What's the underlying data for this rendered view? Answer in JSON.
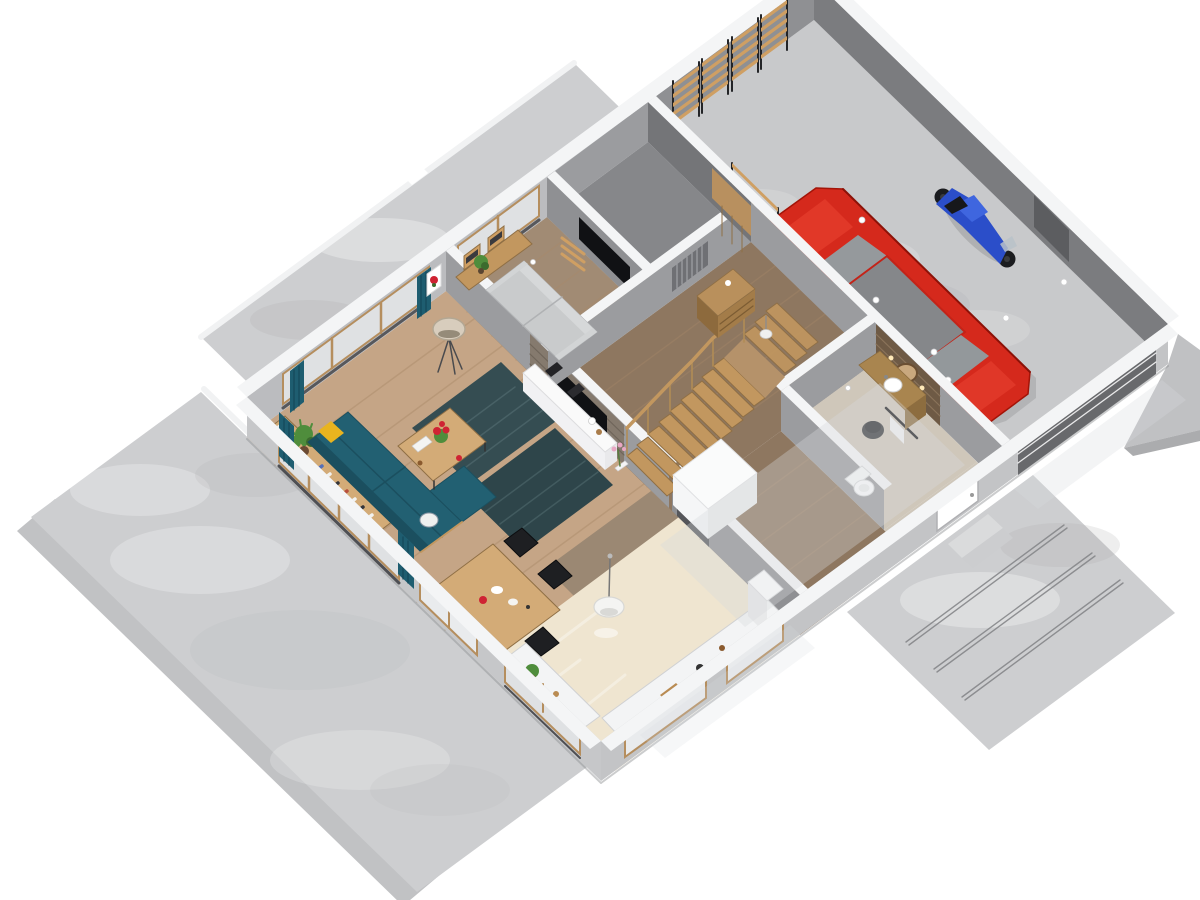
{
  "scene": {
    "kind": "isometric-3d-floor-plan-cutaway-render",
    "rooms": [
      {
        "id": "living-room",
        "floor": "floor_living"
      },
      {
        "id": "dining-area",
        "floor": "floor_living"
      },
      {
        "id": "den-tv-room",
        "floor": "floor_den"
      },
      {
        "id": "storage-closet",
        "floor": "floor_closet"
      },
      {
        "id": "hallway",
        "floor": "floor_hall"
      },
      {
        "id": "entry-corridor",
        "floor": "floor_hall"
      },
      {
        "id": "bathroom",
        "floor": "floor_bath"
      },
      {
        "id": "kitchen",
        "floor": "floor_kitchen"
      },
      {
        "id": "garage",
        "floor": "floor_garage"
      },
      {
        "id": "terrace",
        "floor": "concrete"
      },
      {
        "id": "driveway",
        "floor": "concrete"
      }
    ],
    "objects": [
      {
        "id": "sectional-sofa",
        "color_key": "sofa_teal"
      },
      {
        "id": "yellow-pillow",
        "color_key": "pillow_yellow"
      },
      {
        "id": "low-bookshelf",
        "color_key": "wood_light"
      },
      {
        "id": "potted-plants",
        "color_key": "plant_green"
      },
      {
        "id": "coffee-table",
        "color_key": "wood_light"
      },
      {
        "id": "area-rug-1",
        "color_key": "rug"
      },
      {
        "id": "area-rug-2",
        "color_key": "rug_dark"
      },
      {
        "id": "dining-table",
        "color_key": "wood_light"
      },
      {
        "id": "dining-chairs",
        "color_key": "frame_black"
      },
      {
        "id": "floor-lamp",
        "color_key": "lamp_shade"
      },
      {
        "id": "tv-media-wall",
        "color_key": "tv_black"
      },
      {
        "id": "media-sideboard",
        "color_key": "white"
      },
      {
        "id": "gray-sofa",
        "color_key": "sofa_gray"
      },
      {
        "id": "den-wall-tv",
        "color_key": "tv_black"
      },
      {
        "id": "staircase",
        "color_key": "wood"
      },
      {
        "id": "understair-cabinet",
        "color_key": "white"
      },
      {
        "id": "hall-dresser",
        "color_key": "door_wood"
      },
      {
        "id": "wall-radiator",
        "color_key": "radiator"
      },
      {
        "id": "pendant-lamps",
        "color_key": "white"
      },
      {
        "id": "kitchen-counters",
        "color_key": "white"
      },
      {
        "id": "wall-oven-column",
        "color_key": "steel"
      },
      {
        "id": "fridge",
        "color_key": "white"
      },
      {
        "id": "vanity-sink",
        "color_key": "mirror_wood"
      },
      {
        "id": "round-mirror",
        "color_key": "mirror_wood"
      },
      {
        "id": "toilet",
        "color_key": "white"
      },
      {
        "id": "laundry-basket",
        "color_key": "basket_dark"
      },
      {
        "id": "red-car",
        "color_key": "car_red"
      },
      {
        "id": "blue-motorcycle",
        "color_key": "bike_blue"
      },
      {
        "id": "garage-shelving",
        "color_key": "shelf_wood"
      },
      {
        "id": "garage-door",
        "color_key": "garage_door"
      },
      {
        "id": "entry-door",
        "color_key": "white"
      },
      {
        "id": "windows",
        "color_key": "glass"
      },
      {
        "id": "teal-curtains",
        "color_key": "curtain"
      },
      {
        "id": "flower-picture",
        "color_key": "flower_red"
      }
    ]
  },
  "colors": {
    "bg": "#ffffff",
    "concrete": "#cdced0",
    "concrete_dark": "#c1c2c4",
    "concrete_edge": "#9fa0a3",
    "wall_cap": "#f4f5f6",
    "wall_face": "#bbbcbf",
    "wall_face_mid": "#9b9c9f",
    "wall_face_dark": "#8f9093",
    "wall_int_dark": "#7b7c7f",
    "floor_living": "#c5a586",
    "plank_line": "#a98a69",
    "floor_den": "#a18b74",
    "floor_hall": "#8e7760",
    "floor_kitchen": "#efe5d0",
    "floor_bath": "#cfc7ba",
    "floor_closet": "#86878a",
    "floor_garage": "#c8c9cb",
    "transition": "#9b8873",
    "rug": "#354d52",
    "rug_dark": "#2e454a",
    "rug_line": "#5b757a",
    "sofa_teal": "#226072",
    "sofa_teal_dark": "#1b4f5f",
    "pillow_yellow": "#e9b41f",
    "cushion_white": "#eef0ef",
    "sofa_gray": "#c9cbcc",
    "sofa_gray_light": "#d6d8d9",
    "wood": "#c2975f",
    "wood_dark": "#8f6f45",
    "wood_light": "#d3ab77",
    "shelf_wood": "#cf9f63",
    "frame_black": "#232427",
    "tv_black": "#101114",
    "glass": "#dfe1e3",
    "glass_light": "#e9ebed",
    "curtain": "#1e5d70",
    "curtain_dark": "#16495a",
    "car_red": "#d5291c",
    "car_red_dark": "#a31408",
    "car_red_light": "#e23a2a",
    "car_glass": "#95999c",
    "bike_blue": "#2b4ec9",
    "bike_blue_light": "#3f66df",
    "wheel_black": "#1b1c1f",
    "white": "#ffffff",
    "off_white": "#efeff1",
    "door_wood": "#b8905f",
    "garage_door": "#68696c",
    "mirror_wood": "#c9a87e",
    "wood_wall": "#6e5a45",
    "flower_red": "#cf2333",
    "plant_green": "#4f8d3c",
    "plant_dark": "#3c6b2e",
    "lamp_shade": "#d8cdbd",
    "steel": "#55565a",
    "line_dark": "#8c8d90",
    "overlay": "#d7dadd",
    "basket_dark": "#3a3b3e",
    "radiator": "#6f7074"
  }
}
